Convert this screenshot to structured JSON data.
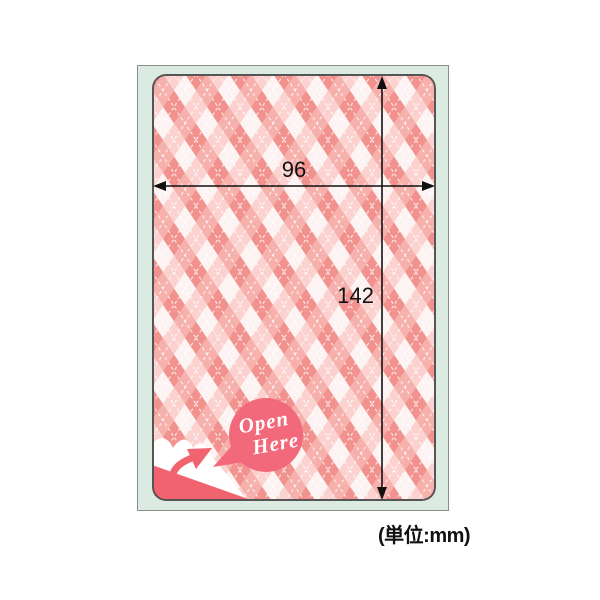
{
  "figure": {
    "type": "product-dimension-diagram",
    "description": "Argyle patterned label sticker on a mint backing sheet with width and height dimension arrows",
    "dims": {
      "width": "96",
      "height": "142",
      "width_mm": 96,
      "height_mm": 142
    },
    "unit_note": "(単位:mm)",
    "badge": {
      "line1": "Open",
      "line2": "Here"
    },
    "icons": [
      "width-dimension-arrow",
      "height-dimension-arrow",
      "peel-arrow-icon",
      "open-here-badge",
      "peeled-corner"
    ],
    "colors": {
      "page_bg": "#ffffff",
      "sheet_bg": "#dcebe2",
      "sheet_border": "#8c8c8c",
      "label_border": "#555555",
      "badge_coral": "#f1697a",
      "peel_coral": "#f0636f",
      "argyle_dark": "#f2928e",
      "argyle_medium": "#f7b1ad",
      "argyle_light": "#fbd2cf",
      "argyle_white": "#fdf3f2",
      "dimension_ink": "#111111"
    }
  }
}
